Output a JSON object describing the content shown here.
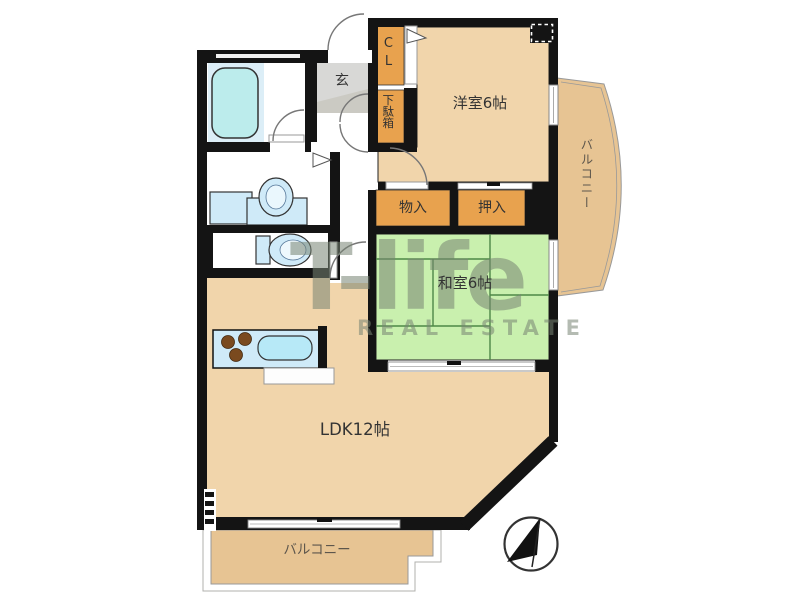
{
  "page": {
    "type": "real-estate-floor-plan",
    "background": "#ffffff"
  },
  "rooms": {
    "western_room": {
      "label": "洋室6帖"
    },
    "japanese_room": {
      "label": "和室6帖"
    },
    "ldk": {
      "label": "LDK12帖"
    },
    "entrance": {
      "label": "玄"
    },
    "closet": {
      "label": "CL"
    },
    "shoe_cabinet": {
      "label": "下駄箱"
    },
    "storage": {
      "label": "物入"
    },
    "futon_closet": {
      "label": "押入"
    },
    "balcony_right": {
      "label": "バルコニー"
    },
    "balcony_bottom": {
      "label": "バルコニー"
    }
  },
  "watermark": {
    "brand": "T-life",
    "subtitle": "REAL ESTATE"
  },
  "icons": {
    "compass": "north-arrow-compass",
    "fixtures": [
      "bathtub",
      "washbasin",
      "washing-machine-pan",
      "toilet",
      "kitchen-counter",
      "sink",
      "stove-burners",
      "pillar"
    ]
  },
  "colors": {
    "wall": "#141414",
    "room_floor": "#f1d5ab",
    "tatami": "#c9f0ae",
    "tatami_line": "#4e8747",
    "closet_orange": "#e8a24e",
    "fixture_blue": "#cfeaf8",
    "bathtub_blue": "#bcecec",
    "entrance_gray": "#d8d8d6",
    "balcony": "#e7c493",
    "watermark": "rgba(118,132,114,0.55)"
  }
}
